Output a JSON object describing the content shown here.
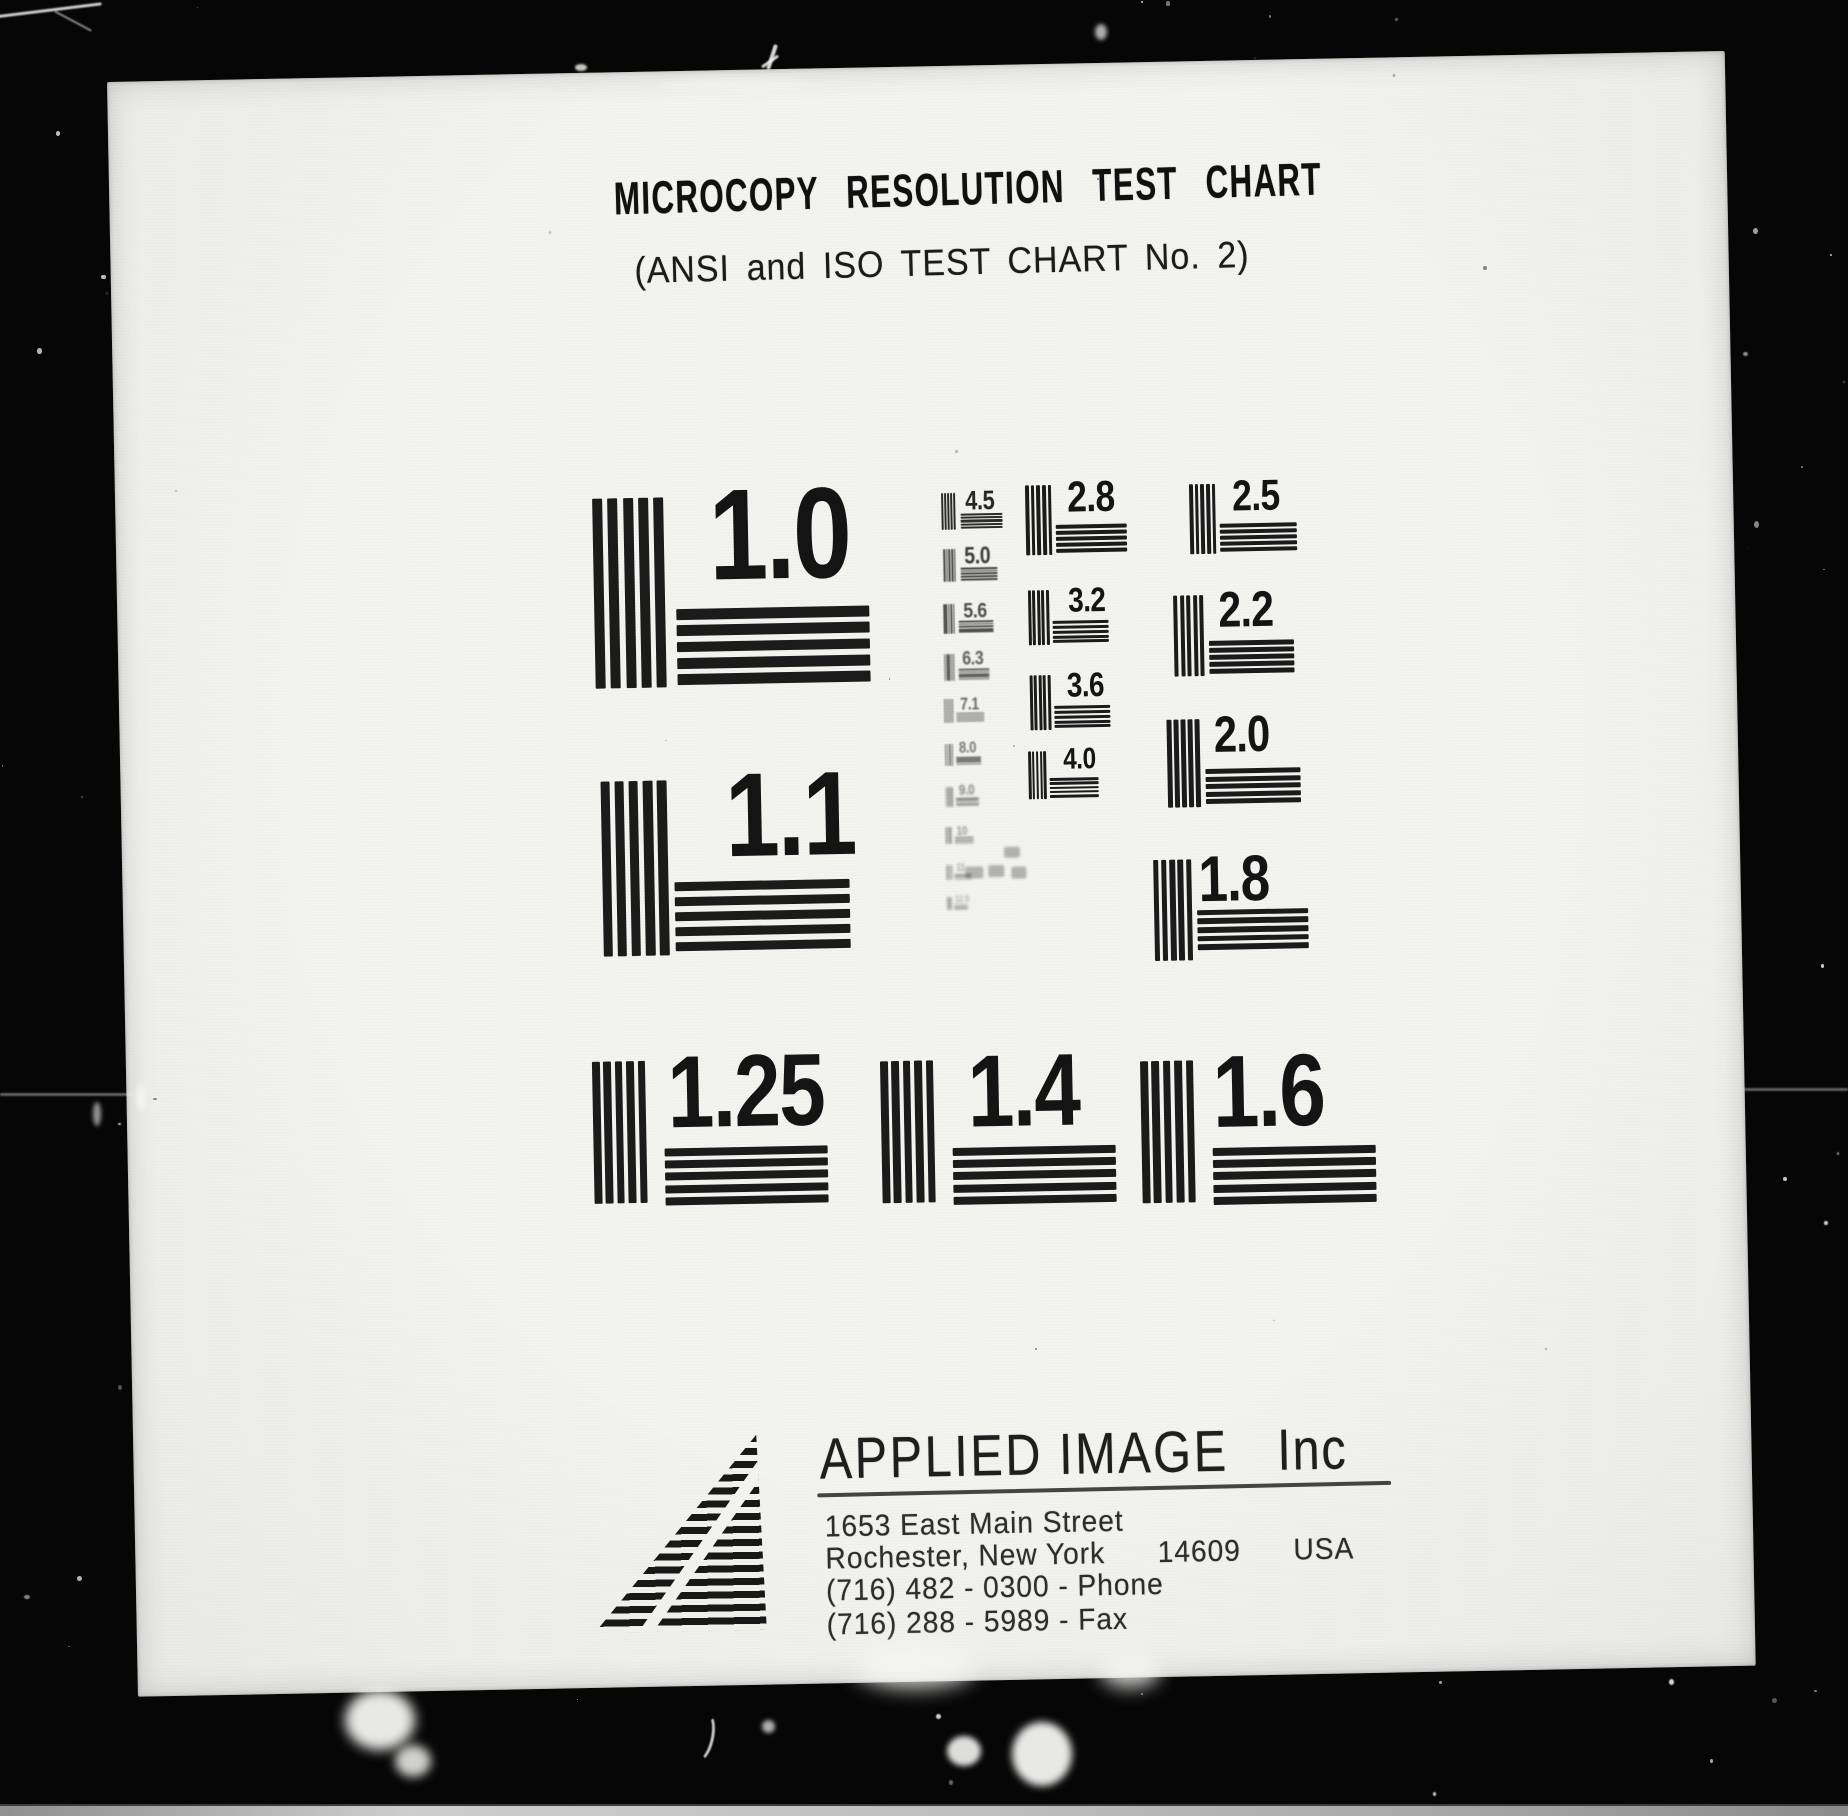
{
  "document": {
    "title": "MICROCOPY RESOLUTION TEST CHART",
    "subtitle": "(ANSI and ISO TEST CHART No. 2)"
  },
  "patches": [
    {
      "label": "1.0",
      "x": 477,
      "y": 426,
      "s": 190,
      "fs": 0.68,
      "ldx": 0.61,
      "hdx": 0.43,
      "hdy": 0.59,
      "hw": 1.02
    },
    {
      "label": "1.1",
      "x": 480,
      "y": 709,
      "s": 175,
      "fs": 0.68,
      "ldx": 0.71,
      "hdx": 0.41,
      "hdy": 0.58,
      "hw": 1.0
    },
    {
      "label": "1.25",
      "x": 466,
      "y": 989,
      "s": 142,
      "fs": 0.72,
      "ldx": 0.53,
      "hdx": 0.5,
      "hdy": 0.62,
      "hw": 1.15
    },
    {
      "label": "1.4",
      "x": 754,
      "y": 994,
      "s": 142,
      "fs": 0.72,
      "ldx": 0.61,
      "hdx": 0.5,
      "hdy": 0.62,
      "hw": 1.15
    },
    {
      "label": "1.6",
      "x": 1014,
      "y": 999,
      "s": 142,
      "fs": 0.72,
      "ldx": 0.51,
      "hdx": 0.5,
      "hdy": 0.62,
      "hw": 1.15
    },
    {
      "label": "4.5",
      "x": 826,
      "y": 427,
      "s": 37,
      "fs": 0.72,
      "ldx": 0.65,
      "hdx": 0.5,
      "hw": 1.15,
      "op": 0.92,
      "blur": 0.3
    },
    {
      "label": "5.0",
      "x": 827,
      "y": 483,
      "s": 33,
      "fs": 0.72,
      "ldx": 0.65,
      "hdx": 0.5,
      "hw": 1.15,
      "op": 0.82,
      "blur": 0.5
    },
    {
      "label": "5.6",
      "x": 826,
      "y": 538,
      "s": 30,
      "fs": 0.72,
      "ldx": 0.65,
      "hdx": 0.5,
      "hw": 1.15,
      "op": 0.75,
      "blur": 0.6
    },
    {
      "label": "6.3",
      "x": 826,
      "y": 588,
      "s": 27,
      "fs": 0.72,
      "ldx": 0.65,
      "hdx": 0.5,
      "hw": 1.15,
      "op": 0.68,
      "blur": 0.7
    },
    {
      "label": "7.1",
      "x": 825,
      "y": 633,
      "s": 24,
      "fs": 0.72,
      "ldx": 0.65,
      "hdx": 0.5,
      "hw": 1.15,
      "op": 0.62,
      "blur": 0.8
    },
    {
      "label": "8.0",
      "x": 825,
      "y": 678,
      "s": 22,
      "fs": 0.72,
      "ldx": 0.65,
      "hdx": 0.5,
      "hw": 1.15,
      "op": 0.56,
      "blur": 0.9
    },
    {
      "label": "9.0",
      "x": 825,
      "y": 721,
      "s": 20,
      "fs": 0.72,
      "ldx": 0.65,
      "hdx": 0.5,
      "hw": 1.15,
      "op": 0.5,
      "blur": 1.0
    },
    {
      "label": "10",
      "x": 824,
      "y": 761,
      "s": 17,
      "fs": 0.72,
      "ldx": 0.65,
      "hdx": 0.5,
      "hw": 1.15,
      "op": 0.42,
      "blur": 1.1
    },
    {
      "label": "11",
      "x": 824,
      "y": 799,
      "s": 15,
      "fs": 0.72,
      "ldx": 0.65,
      "hdx": 0.5,
      "hw": 1.15,
      "op": 0.36,
      "blur": 1.2
    },
    {
      "label": "12.5",
      "x": 824,
      "y": 831,
      "s": 13,
      "fs": 0.72,
      "ldx": 0.65,
      "hdx": 0.5,
      "hw": 1.15,
      "op": 0.32,
      "blur": 1.2
    },
    {
      "label": "2.8",
      "x": 910,
      "y": 421,
      "s": 70,
      "ldx": 0.6
    },
    {
      "label": "3.2",
      "x": 911,
      "y": 526,
      "s": 55,
      "ldx": 0.73
    },
    {
      "label": "3.6",
      "x": 911,
      "y": 611,
      "s": 55,
      "ldx": 0.67
    },
    {
      "label": "4.0",
      "x": 908,
      "y": 687,
      "s": 48,
      "ldx": 0.73
    },
    {
      "label": "2.5",
      "x": 1074,
      "y": 423,
      "s": 70,
      "ldx": 0.61,
      "hw": 1.1
    },
    {
      "label": "2.2",
      "x": 1056,
      "y": 534,
      "s": 81,
      "ldx": 0.56,
      "hw": 1.05
    },
    {
      "label": "2.0",
      "x": 1047,
      "y": 658,
      "s": 88,
      "fs": 0.58,
      "ldx": 0.53,
      "hw": 1.08
    },
    {
      "label": "1.8",
      "x": 1031,
      "y": 798,
      "s": 101,
      "fs": 0.64,
      "ldx": 0.45,
      "hdy": 0.5,
      "hw": 1.09
    }
  ],
  "faint_marks": [
    {
      "x": 882,
      "y": 782,
      "w": 16,
      "h": 11
    },
    {
      "x": 843,
      "y": 801,
      "w": 18,
      "h": 12
    },
    {
      "x": 866,
      "y": 800,
      "w": 16,
      "h": 12
    },
    {
      "x": 889,
      "y": 802,
      "w": 15,
      "h": 12
    }
  ],
  "footer": {
    "company": "APPLIED IMAGE",
    "company_suffix": "Inc",
    "address_line1": "1653 East Main Street",
    "address_line2": "Rochester, New York      14609      USA",
    "phone_line": "(716) 482 - 0300 - Phone",
    "fax_line": "(716) 288 - 5989 - Fax"
  },
  "colors": {
    "paper": "#f3f3f0",
    "ink": "#1b1b1b",
    "background": "#060606"
  }
}
